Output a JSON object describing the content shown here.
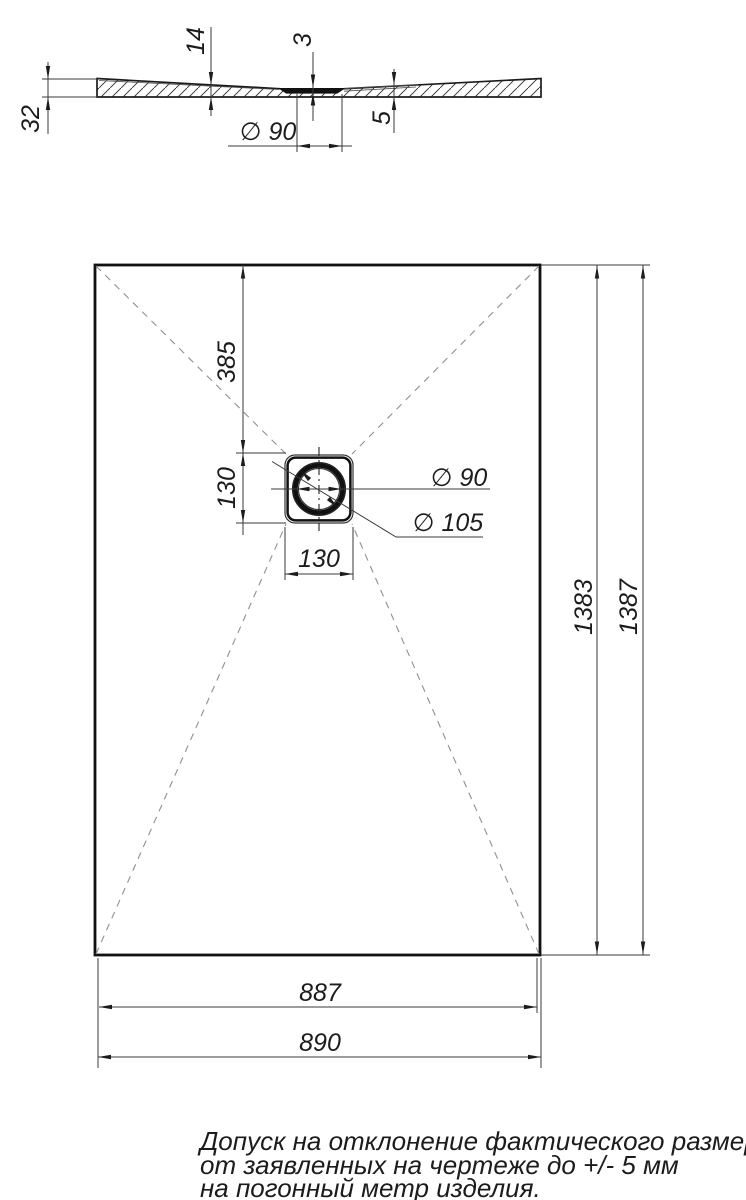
{
  "section_view": {
    "dim_edge_height": "32",
    "dim_slope_thickness": "14",
    "dim_drain_thickness": "3",
    "dim_right_thickness": "5",
    "dim_drain_diameter": "∅ 90"
  },
  "plan_view": {
    "dim_top_to_drain": "385",
    "dim_drain_height": "130",
    "dim_drain_width": "130",
    "dim_drain_inner_diameter": "∅ 90",
    "dim_drain_outer_diameter": "∅ 105",
    "dim_length_inner": "1383",
    "dim_length_outer": "1387",
    "dim_width_inner": "887",
    "dim_width_outer": "890"
  },
  "tolerance_note": {
    "line1": "Допуск на отклонение фактического размера",
    "line2": "от заявленных на чертеже до +/- 5 мм",
    "line3": "на погонный метр изделия."
  }
}
